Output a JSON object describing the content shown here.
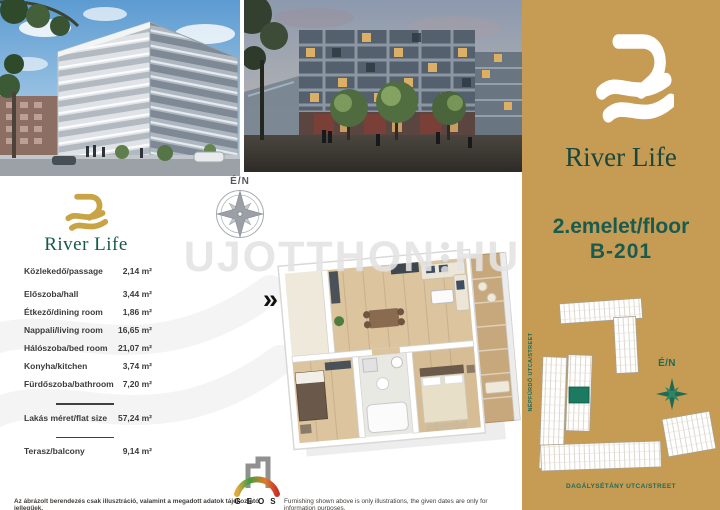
{
  "brand": {
    "name": "River Life"
  },
  "compass": {
    "label": "É/N"
  },
  "watermark": {
    "left": "UJOTTHON",
    "right": "HU"
  },
  "floorplan": {
    "chevrons": "»"
  },
  "area_table": {
    "rows": [
      {
        "label": "Közlekedő/passage",
        "value": "2,14 m²"
      },
      {
        "label": "Előszoba/hall",
        "value": "3,44 m²"
      },
      {
        "label": "Étkező/dining room",
        "value": "1,86 m²"
      },
      {
        "label": "Nappali/living room",
        "value": "16,65 m²"
      },
      {
        "label": "Hálószoba/bed room",
        "value": "21,07 m²"
      },
      {
        "label": "Konyha/kitchen",
        "value": "3,74 m²"
      },
      {
        "label": "Fürdőszoba/bathroom",
        "value": "7,20 m²"
      }
    ],
    "total": {
      "label": "Lakás méret/flat size",
      "value": "57,24 m²"
    },
    "balcony": {
      "label": "Terasz/balcony",
      "value": "9,14 m²"
    }
  },
  "sidebar": {
    "brand": "River Life",
    "floor": "2.emelet/floor",
    "unit": "B-201",
    "compass_label": "É/N",
    "street_left": "NÉPFÜRDŐ UTCA/STREET",
    "street_bottom": "DAGÁLYSÉTÁNY UTCA/STREET"
  },
  "footer": {
    "disclaimer_hu": "Az ábrázolt berendezés csak illusztráció, valamint a megadott adatok tájékoztató jellegűek.",
    "geos_label": "GEOS",
    "disclaimer_en": "Furnishing shown above is only illustrations, the given dates are only for information purposes."
  },
  "colors": {
    "gold": "#C69B53",
    "teal": "#17584B",
    "unit_highlight": "#1C7A60"
  }
}
